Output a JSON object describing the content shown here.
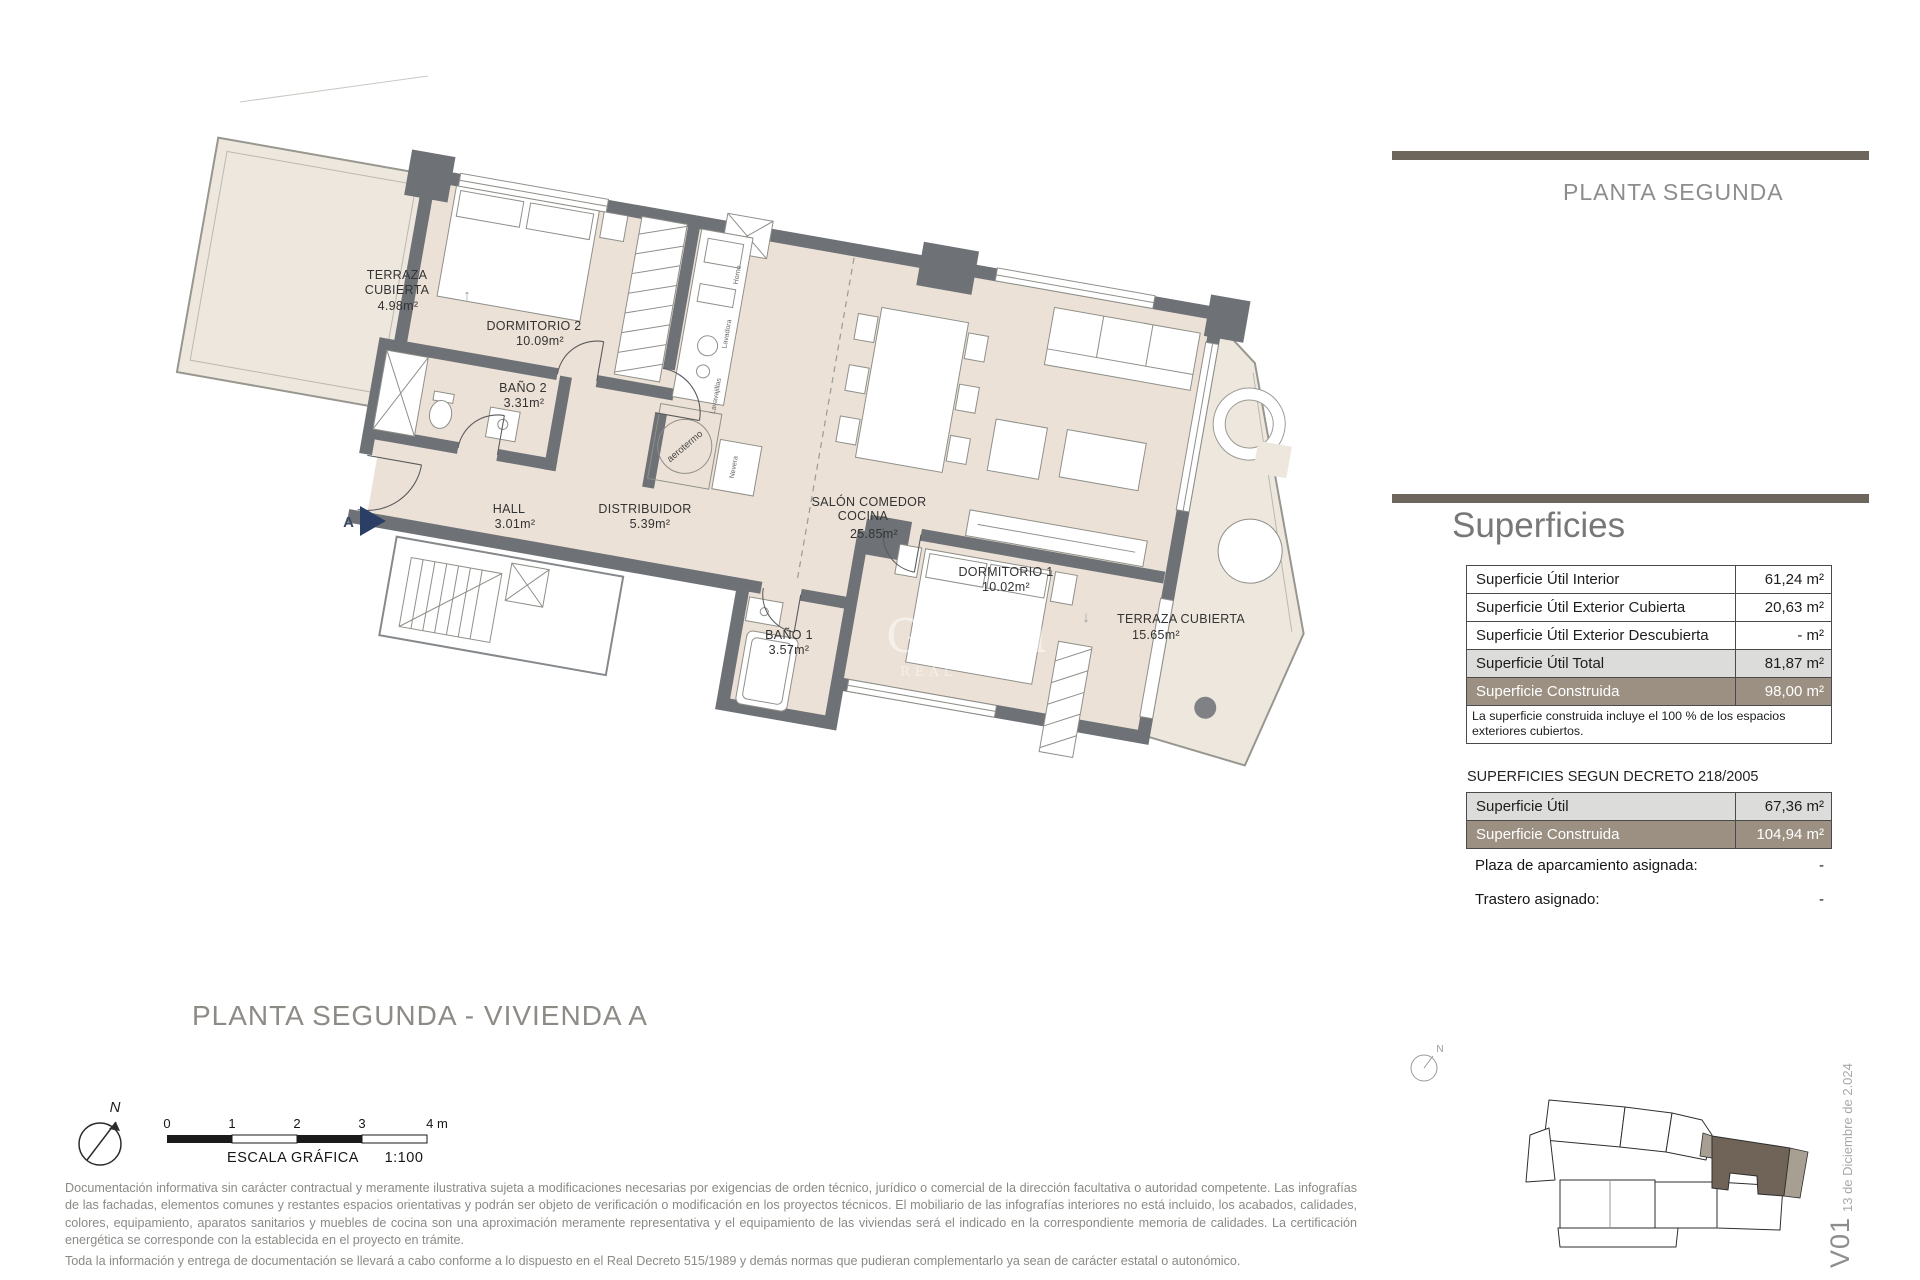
{
  "header": {
    "floor_label": "PLANTA SEGUNDA"
  },
  "plan": {
    "rooms": {
      "terraza2": {
        "name1": "TERRAZA",
        "name2": "CUBIERTA",
        "area": "4.98m²"
      },
      "dorm2": {
        "name": "DORMITORIO 2",
        "area": "10.09m²"
      },
      "bano2": {
        "name": "BAÑO 2",
        "area": "3.31m²"
      },
      "hall": {
        "name": "HALL",
        "area": "3.01m²"
      },
      "distribuidor": {
        "name": "DISTRIBUIDOR",
        "area": "5.39m²"
      },
      "salon": {
        "name1": "SALÓN COMEDOR",
        "name2": "COCINA",
        "area": "25.85m²"
      },
      "dorm1": {
        "name": "DORMITORIO 1",
        "area": "10.02m²"
      },
      "bano1": {
        "name": "BAÑO 1",
        "area": "3.57m²"
      },
      "terraza1": {
        "name": "TERRAZA CUBIERTA",
        "area": "15.65m²"
      }
    },
    "entrance_label": "A",
    "aerotermo_label": "aerotermo",
    "appliances": {
      "a1": "Horno",
      "a2": "Lavadora",
      "a3": "Lavavajillas",
      "a4": "Nevera"
    },
    "window_arrows": {
      "up": "↑",
      "down": "↓"
    },
    "watermark": {
      "line1": "Global",
      "line2": "REAL"
    }
  },
  "superficies": {
    "title": "Superficies",
    "table": {
      "rows": [
        {
          "label": "Superficie Útil Interior",
          "value": "61,24 m²"
        },
        {
          "label": "Superficie Útil Exterior Cubierta",
          "value": "20,63 m²"
        },
        {
          "label": "Superficie Útil Exterior Descubierta",
          "value": "- m²"
        },
        {
          "label": "Superficie Útil Total",
          "value": "81,87 m²"
        },
        {
          "label": "Superficie Construida",
          "value": "98,00 m²"
        }
      ],
      "note": "La superficie construida incluye el 100 % de los espacios exteriores cubiertos."
    },
    "decreto_title": "SUPERFICIES SEGUN DECRETO 218/2005",
    "decreto_rows": [
      {
        "label": "Superficie Útil",
        "value": "67,36 m²"
      },
      {
        "label": "Superficie Construida",
        "value": "104,94 m²"
      }
    ],
    "assignments": [
      {
        "label": "Plaza de aparcamiento asignada:",
        "value": "-"
      },
      {
        "label": "Trastero asignado:",
        "value": "-"
      }
    ]
  },
  "footer": {
    "plan_title": "PLANTA SEGUNDA - VIVIENDA A",
    "scale": {
      "ticks": [
        "0",
        "1",
        "2",
        "3",
        "4 m"
      ],
      "caption": "ESCALA GRÁFICA",
      "ratio": "1:100"
    },
    "north_label": "N",
    "disclaimer1": "Documentación informativa sin carácter contractual y meramente ilustrativa sujeta a modificaciones necesarias por exigencias de orden técnico, jurídico o comercial de la dirección facultativa o autoridad competente. Las infografías de las fachadas, elementos comunes y restantes espacios orientativas y podrán ser objeto de verificación o modificación en los proyectos técnicos. El mobiliario de las infografías interiores no está incluido, los acabados, calidades, colores, equipamiento, aparatos sanitarios y muebles de cocina son una aproximación meramente representativa y el equipamiento de las viviendas será el indicado en la correspondiente memoria de calidades. La certificación energética se corresponde con la establecida en el proyecto en trámite.",
    "disclaimer2": "Toda la información y entrega de documentación se llevará a cabo conforme a lo dispuesto en el Real Decreto 515/1989 y demás normas que pudieran complementarlo ya sean de carácter estatal o autonómico."
  },
  "siteplan": {
    "north_label": "N"
  },
  "version": {
    "code": "V01",
    "date": "13 de Diciembre de 2.024"
  }
}
